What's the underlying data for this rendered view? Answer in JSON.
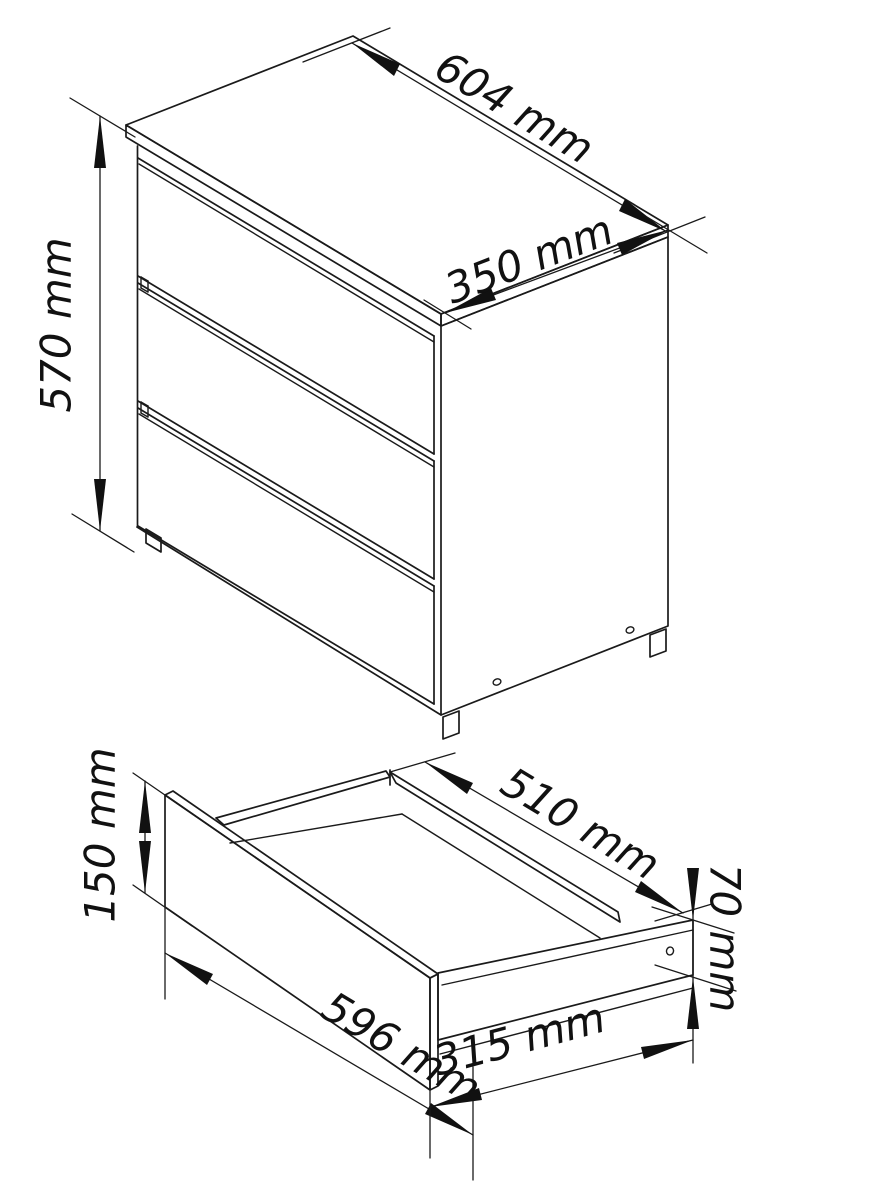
{
  "drawing": {
    "background_color": "#ffffff",
    "line_color": "#1a1a1a",
    "unit": "mm",
    "cabinet": {
      "description": "3-drawer chest, isometric projection",
      "drawer_count": 3,
      "dim_width": "604 mm",
      "dim_depth": "350 mm",
      "dim_height": "570 mm"
    },
    "drawer": {
      "description": "single open drawer, isometric projection",
      "dim_inner_depth": "510 mm",
      "dim_front_height": "150 mm",
      "dim_front_width": "596 mm",
      "dim_side_length": "315 mm",
      "dim_side_height": "70 mm"
    }
  }
}
